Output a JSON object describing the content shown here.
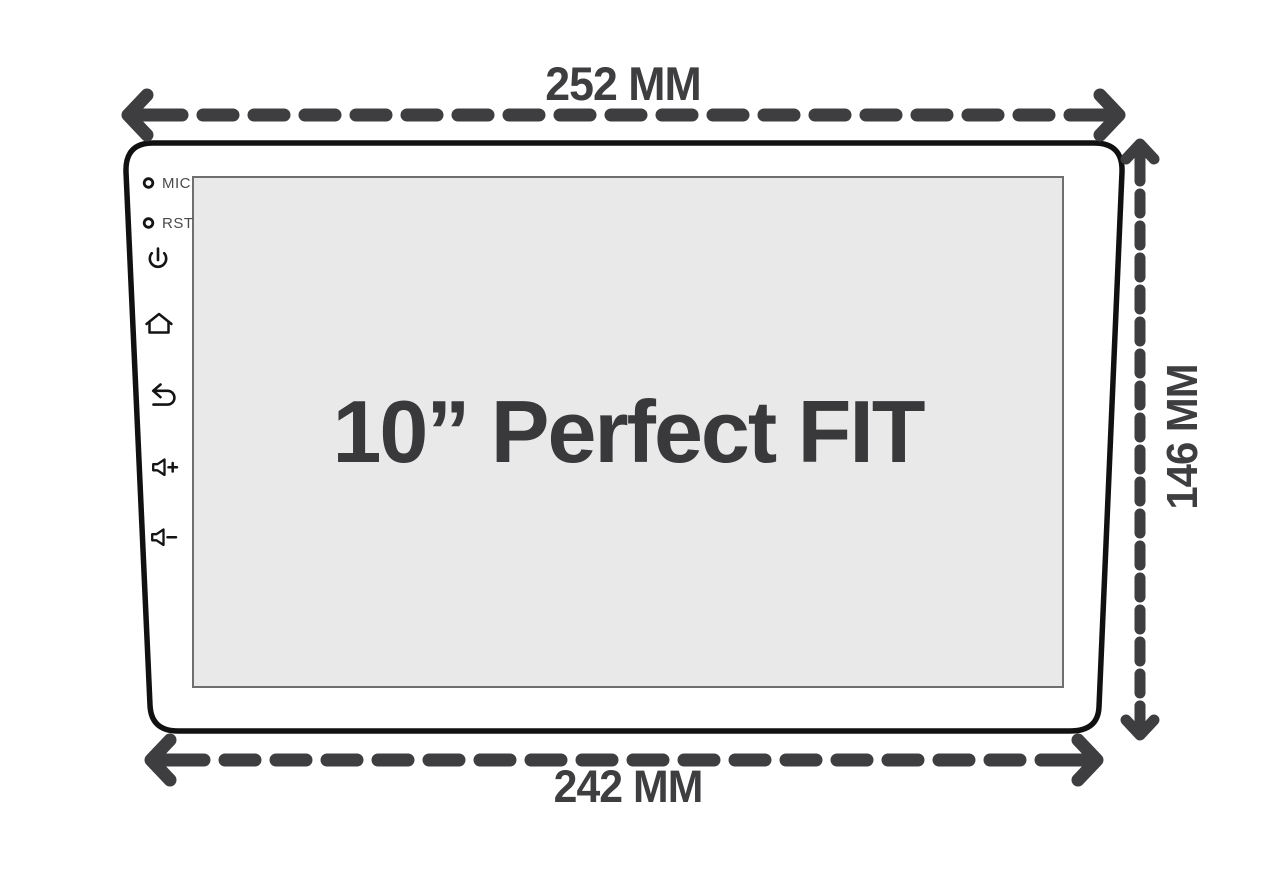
{
  "diagram": {
    "screen_label": "10” Perfect FIT",
    "dimensions": {
      "top_width": "252 MM",
      "bottom_width": "242 MM",
      "side_height": "146 MM"
    },
    "port_labels": {
      "mic": "MIC",
      "reset": "RST"
    },
    "side_buttons": [
      "power",
      "home",
      "back",
      "volume-up",
      "volume-down"
    ],
    "colors": {
      "dimension": "#3e3e40",
      "bezel_outline": "#111111",
      "screen_fill": "#e9e9e9",
      "screen_border": "#6f6f6f",
      "title_text": "#39393b"
    }
  }
}
